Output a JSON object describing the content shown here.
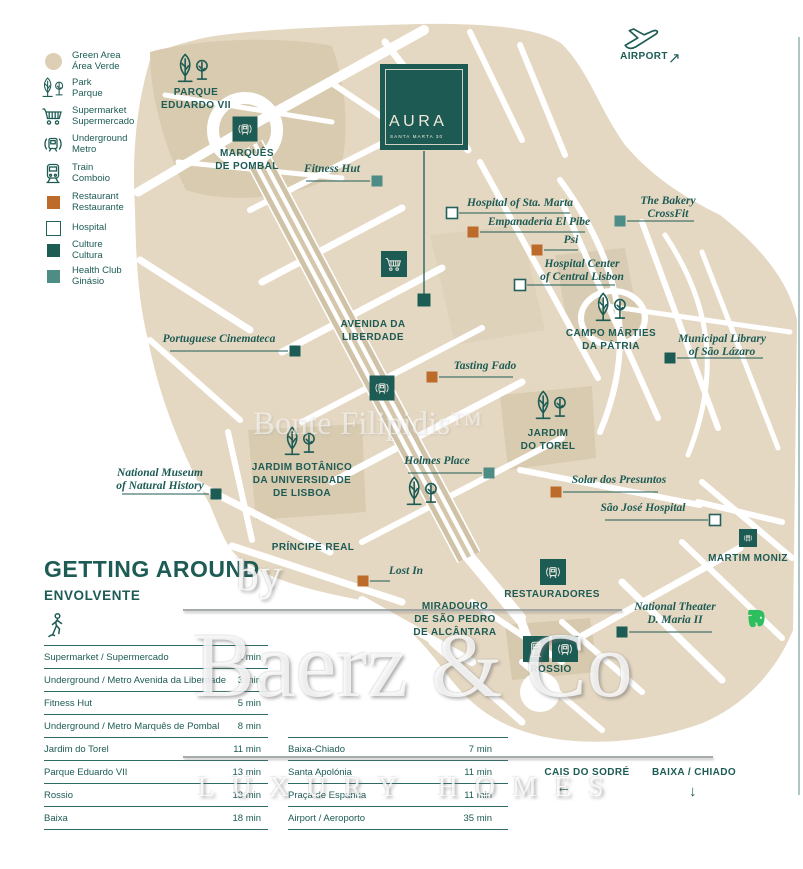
{
  "colors": {
    "teal_dark": "#1D5B55",
    "teal_health": "#4E8C86",
    "orange": "#BD6B2B",
    "beige": "#E5D8C2",
    "beige_dark": "#D8CBB0",
    "green_area": "#DCCFB6",
    "evernote_green": "#2DBE60",
    "white": "#FFFFFF"
  },
  "legend": {
    "items": [
      {
        "icon": "green-area",
        "cy": 61,
        "lines": [
          "Green Area",
          "Área Verde"
        ]
      },
      {
        "icon": "park",
        "cy": 88,
        "lines": [
          "Park",
          "Parque"
        ]
      },
      {
        "icon": "supermarket",
        "cy": 116,
        "lines": [
          "Supermarket",
          "Supermercado"
        ]
      },
      {
        "icon": "underground",
        "cy": 144,
        "lines": [
          "Underground",
          "Metro"
        ]
      },
      {
        "icon": "train",
        "cy": 173,
        "lines": [
          "Train",
          "Comboio"
        ]
      },
      {
        "icon": "restaurant",
        "cy": 202,
        "lines": [
          "Restaurant",
          "Restaurante"
        ]
      },
      {
        "icon": "hospital",
        "cy": 228,
        "lines": [
          "Hospital"
        ]
      },
      {
        "icon": "culture",
        "cy": 250,
        "lines": [
          "Culture",
          "Cultura"
        ]
      },
      {
        "icon": "health",
        "cy": 276,
        "lines": [
          "Health Club",
          "Ginásio"
        ]
      }
    ]
  },
  "aura": {
    "title": "AURA",
    "subtitle": "SANTA MARTA 30"
  },
  "map": {
    "labels": [
      {
        "id": "parque-eduardo-vii",
        "cx": 196,
        "top": 86,
        "lines": [
          "PARQUE",
          "EDUARDO VII"
        ]
      },
      {
        "id": "marques-de-pombal",
        "cx": 247,
        "top": 147,
        "lines": [
          "MARQUÊS",
          "DE POMBAL"
        ]
      },
      {
        "id": "avenida-da-liberdade",
        "cx": 373,
        "top": 318,
        "lines": [
          "AVENIDA DA",
          "LIBERDADE"
        ]
      },
      {
        "id": "campo-marties-da-patria",
        "cx": 611,
        "top": 327,
        "lines": [
          "CAMPO MÁRTIES",
          "DA PÁTRIA"
        ]
      },
      {
        "id": "jardim-do-torel",
        "cx": 548,
        "top": 427,
        "lines": [
          "JARDIM",
          "DO TOREL"
        ]
      },
      {
        "id": "jardim-botanico",
        "cx": 302,
        "top": 461,
        "lines": [
          "JARDIM BOTÂNICO",
          "DA UNIVERSIDADE",
          "DE LISBOA"
        ]
      },
      {
        "id": "principe-real",
        "cx": 313,
        "top": 541,
        "lines": [
          "PRÍNCIPE REAL"
        ]
      },
      {
        "id": "martim-moniz",
        "cx": 748,
        "top": 552,
        "lines": [
          "MARTIM MONIZ"
        ]
      },
      {
        "id": "restauradores",
        "cx": 552,
        "top": 588,
        "lines": [
          "RESTAURADORES"
        ]
      },
      {
        "id": "miradouro-sao-pedro-alcantara",
        "cx": 455,
        "top": 600,
        "lines": [
          "MIRADOURO",
          "DE SÃO PEDRO",
          "DE ALCÂNTARA"
        ]
      },
      {
        "id": "rossio",
        "cx": 551,
        "top": 663,
        "lines": [
          "ROSSIO"
        ]
      },
      {
        "id": "cais-do-sodre",
        "cx": 587,
        "top": 766,
        "lines": [
          "CAIS DO SODRÉ"
        ],
        "arrow": "←",
        "ax": 556,
        "ay": 779
      },
      {
        "id": "baixa-chiado",
        "cx": 694,
        "top": 766,
        "lines": [
          "BAIXA / CHIADO"
        ],
        "arrow": "↓",
        "ax": 689,
        "ay": 783
      },
      {
        "id": "airport",
        "cx": 644,
        "top": 50,
        "lines": [
          "AIRPORT"
        ],
        "arrow": "↗",
        "ax": 668,
        "ay": 49
      }
    ],
    "pois": [
      {
        "id": "fitness-hut",
        "type": "health",
        "cx": 332,
        "top": 163,
        "lines": [
          "Fitness Hut"
        ],
        "line": [
          306,
          181,
          370,
          181
        ],
        "m": [
          377,
          181
        ]
      },
      {
        "id": "hospital-sta-marta",
        "type": "hospital",
        "cx": 520,
        "top": 197,
        "lines": [
          "Hospital of Sta. Marta"
        ],
        "line": [
          459,
          213,
          570,
          213
        ],
        "m": [
          452,
          213
        ]
      },
      {
        "id": "empanaderia-el-pibe",
        "type": "restaurant",
        "cx": 539,
        "top": 216,
        "lines": [
          "Empanaderia El Pibe"
        ],
        "line": [
          480,
          232,
          585,
          232
        ],
        "m": [
          473,
          232
        ]
      },
      {
        "id": "psi",
        "type": "restaurant",
        "cx": 571,
        "top": 234,
        "lines": [
          "Psi"
        ],
        "line": [
          544,
          250,
          578,
          250
        ],
        "m": [
          537,
          250
        ]
      },
      {
        "id": "bakery-crossfit",
        "type": "health",
        "cx": 668,
        "top": 195,
        "lines": [
          "The Bakery",
          "CrossFit"
        ],
        "line": [
          627,
          221,
          694,
          221
        ],
        "m": [
          620,
          221
        ]
      },
      {
        "id": "hospital-center-lisbon",
        "type": "hospital",
        "cx": 582,
        "top": 258,
        "lines": [
          "Hospital Center",
          "of  Central Lisbon"
        ],
        "line": [
          527,
          285,
          615,
          285
        ],
        "m": [
          520,
          285
        ]
      },
      {
        "id": "municipal-library",
        "type": "culture",
        "cx": 722,
        "top": 333,
        "lines": [
          "Municipal Library",
          "of São Lázaro"
        ],
        "line": [
          677,
          358,
          763,
          358
        ],
        "m": [
          670,
          358
        ]
      },
      {
        "id": "portuguese-cinemateca",
        "type": "culture",
        "cx": 219,
        "top": 333,
        "lines": [
          "Portuguese Cinemateca"
        ],
        "line": [
          170,
          351,
          288,
          351
        ],
        "m": [
          295,
          351
        ]
      },
      {
        "id": "tasting-fado",
        "type": "restaurant",
        "cx": 485,
        "top": 360,
        "lines": [
          "Tasting Fado"
        ],
        "line": [
          439,
          377,
          513,
          377
        ],
        "m": [
          432,
          377
        ]
      },
      {
        "id": "holmes-place",
        "type": "health",
        "cx": 437,
        "top": 455,
        "lines": [
          "Holmes Place"
        ],
        "line": [
          408,
          473,
          482,
          473
        ],
        "m": [
          489,
          473
        ]
      },
      {
        "id": "national-museum-natural-history",
        "type": "culture",
        "cx": 160,
        "top": 467,
        "lines": [
          "National Museum",
          "of Natural History"
        ],
        "line": [
          122,
          494,
          209,
          494
        ],
        "m": [
          216,
          494
        ]
      },
      {
        "id": "solar-dos-presuntos",
        "type": "restaurant",
        "cx": 619,
        "top": 474,
        "lines": [
          "Solar dos Presuntos"
        ],
        "line": [
          563,
          492,
          658,
          492
        ],
        "m": [
          556,
          492
        ]
      },
      {
        "id": "sao-jose-hospital",
        "type": "hospital",
        "cx": 643,
        "top": 502,
        "lines": [
          "São José Hospital"
        ],
        "line": [
          605,
          520,
          708,
          520
        ],
        "m": [
          715,
          520
        ]
      },
      {
        "id": "lost-in",
        "type": "restaurant",
        "cx": 406,
        "top": 565,
        "lines": [
          "Lost In"
        ],
        "line": [
          370,
          581,
          390,
          581
        ],
        "m": [
          363,
          581
        ]
      },
      {
        "id": "national-theater-d-maria",
        "type": "culture",
        "cx": 675,
        "top": 601,
        "lines": [
          "National Theater",
          "D. Maria II"
        ],
        "line": [
          629,
          632,
          712,
          632
        ],
        "m": [
          622,
          632
        ]
      }
    ],
    "stations": [
      {
        "t": "underground",
        "x": 245,
        "y": 129,
        "s": 25
      },
      {
        "t": "underground",
        "x": 382,
        "y": 388,
        "s": 25
      },
      {
        "t": "underground",
        "x": 553,
        "y": 572,
        "s": 26
      },
      {
        "t": "underground",
        "x": 748,
        "y": 538,
        "s": 18
      },
      {
        "t": "train",
        "x": 536,
        "y": 649,
        "s": 26
      },
      {
        "t": "underground",
        "x": 565,
        "y": 649,
        "s": 26
      },
      {
        "t": "supermarket",
        "x": 394,
        "y": 264,
        "s": 26
      }
    ],
    "trees": [
      [
        193,
        69
      ],
      [
        611,
        308
      ],
      [
        551,
        406
      ],
      [
        300,
        442
      ],
      [
        422,
        492
      ]
    ]
  },
  "watermarks": {
    "bonte": "Bonte Filipidis™",
    "by": "by",
    "brand": "Baerz & Co",
    "tagline": "LUXURY HOMES"
  },
  "getting_around": {
    "title": "GETTING AROUND",
    "subtitle": "ENVOLVENTE",
    "left_rows": [
      {
        "label": "Supermarket / Supermercado",
        "value": "1 min"
      },
      {
        "label": "Underground / Metro Avenida da Liberdade",
        "value": "3 min"
      },
      {
        "label": "Fitness Hut",
        "value": "5 min"
      },
      {
        "label": "Underground / Metro Marquês de Pombal",
        "value": "8 min"
      },
      {
        "label": "Jardim do Torel",
        "value": "11 min"
      },
      {
        "label": "Parque Eduardo VII",
        "value": "13 min"
      },
      {
        "label": "Rossio",
        "value": "13 min"
      },
      {
        "label": "Baixa",
        "value": "18 min"
      }
    ],
    "right_rows": [
      {
        "label": "Baixa-Chiado",
        "value": "7 min"
      },
      {
        "label": "Santa Apolónia",
        "value": "11 min"
      },
      {
        "label": "Praça de Espanha",
        "value": "11 min"
      },
      {
        "label": "Airport / Aeroporto",
        "value": "35 min"
      }
    ]
  }
}
